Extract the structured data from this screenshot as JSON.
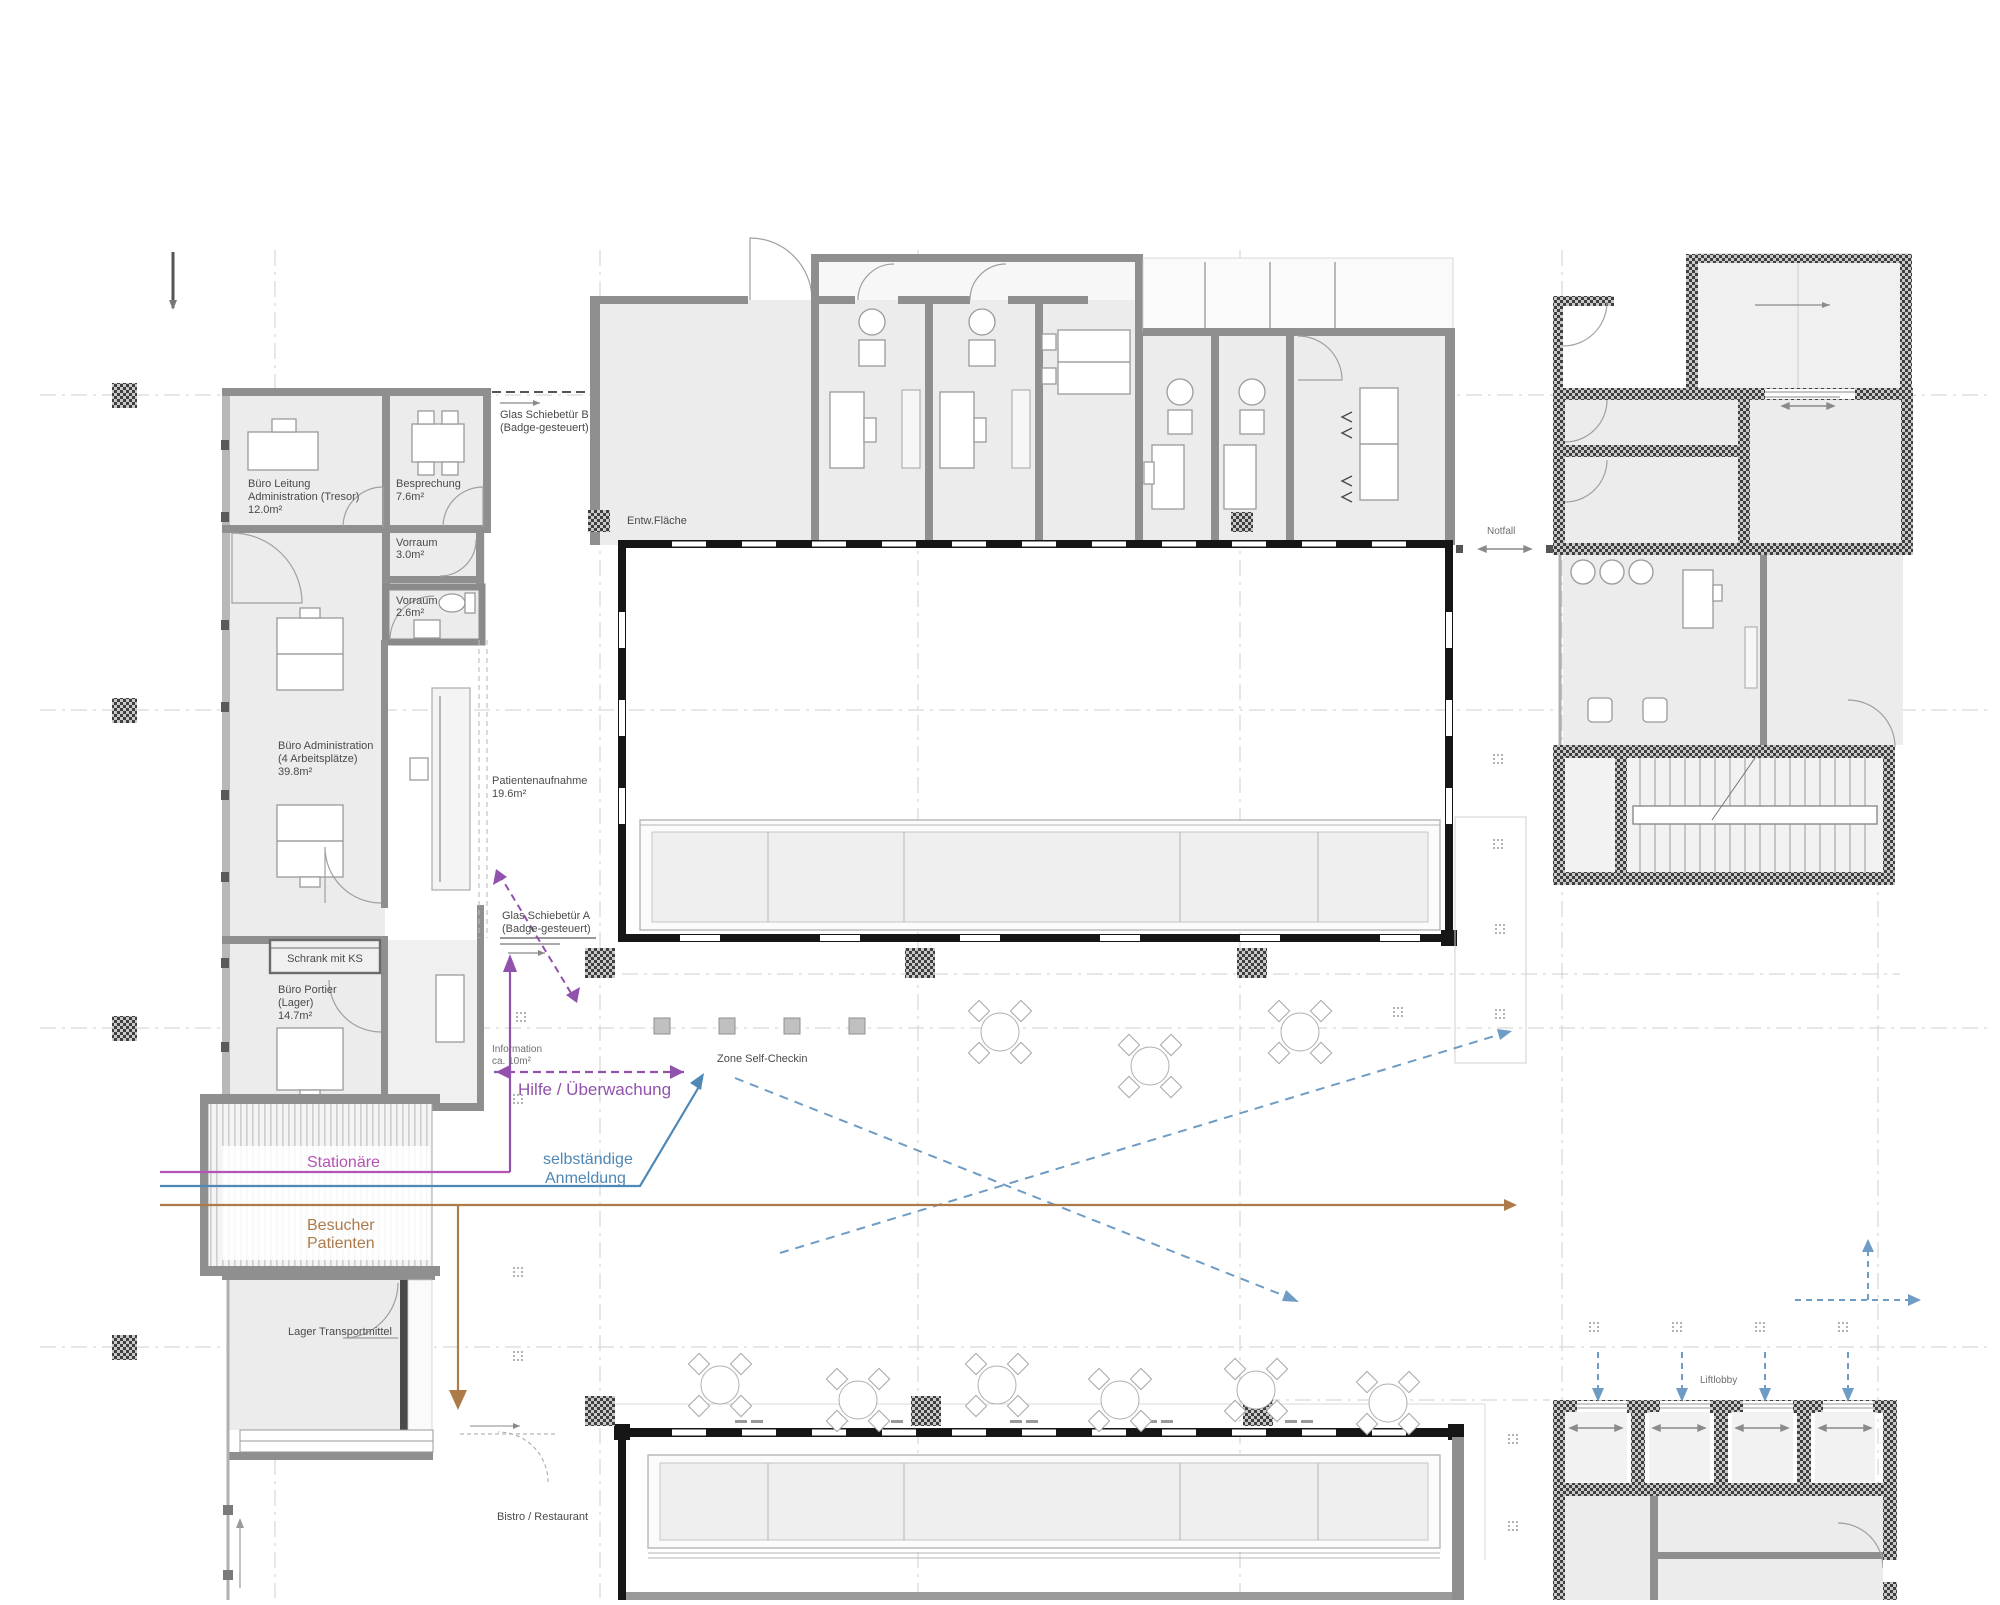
{
  "drawing": {
    "type": "architectural floor plan (hospital entrance level)",
    "language": "German"
  },
  "colors": {
    "route_help": "#9152ad",
    "route_stationaere": "#b553b5",
    "route_self_registration": "#4f87b5",
    "route_wayfinding_dashed": "#6f9cc4",
    "route_visitors_patients": "#ad7b4a",
    "room_fill": "#ececec",
    "wall_dark": "#161616",
    "wall_gray": "#8f8f8f"
  },
  "rooms": {
    "buero_leitung": {
      "lines": [
        "Büro Leitung",
        "Administration (Tresor)",
        "12.0m²"
      ]
    },
    "besprechung": {
      "lines": [
        "Besprechung",
        "7.6m²"
      ]
    },
    "vorraum_3": {
      "lines": [
        "Vorraum",
        "3.0m²"
      ]
    },
    "vorraum_26": {
      "lines": [
        "Vorraum",
        "2.6m²"
      ]
    },
    "buero_administration": {
      "lines": [
        "Büro Administration",
        "(4 Arbeitsplätze)",
        "39.8m²"
      ]
    },
    "patientenaufnahme": {
      "lines": [
        "Patientenaufnahme",
        "19.6m²"
      ]
    },
    "buero_portier": {
      "lines": [
        "Büro Portier",
        "(Lager)",
        "14.7m²"
      ]
    },
    "information": {
      "lines": [
        "Information",
        "ca. 10m²"
      ]
    }
  },
  "doors": {
    "glas_schiebetuer_a": {
      "lines": [
        "Glas Schiebetür A",
        "(Badge-gesteuert)"
      ]
    },
    "glas_schiebetuer_b": {
      "lines": [
        "Glas Schiebetür B",
        "(Badge-gesteuert)"
      ]
    }
  },
  "zones": {
    "entw_flaeche": "Entw.Fläche",
    "zone_self_checkin": "Zone Self-Checkin",
    "schrank_mit_ks": "Schrank mit KS",
    "lager_transportmittel": "Lager Transportmittel",
    "bistro_restaurant": "Bistro / Restaurant",
    "notfall": "Notfall",
    "liftlobby": "Liftlobby"
  },
  "routes": {
    "hilfe": {
      "label": "Hilfe / Überwachung",
      "color": "#9152ad",
      "style": "dashed double arrow"
    },
    "stationaere": {
      "label": "Stationäre",
      "color": "#b553b5",
      "style": "solid line"
    },
    "selbstaendige": {
      "lines": [
        "selbständige",
        "Anmeldung"
      ],
      "color": "#4f87b5",
      "style": "solid arrow"
    },
    "besucher": {
      "lines": [
        "Besucher",
        "Patienten"
      ],
      "color": "#ad7b4a",
      "style": "solid arrows"
    },
    "wayfinding": {
      "label": "",
      "color": "#6f9cc4",
      "style": "dashed arrows to lifts"
    }
  }
}
